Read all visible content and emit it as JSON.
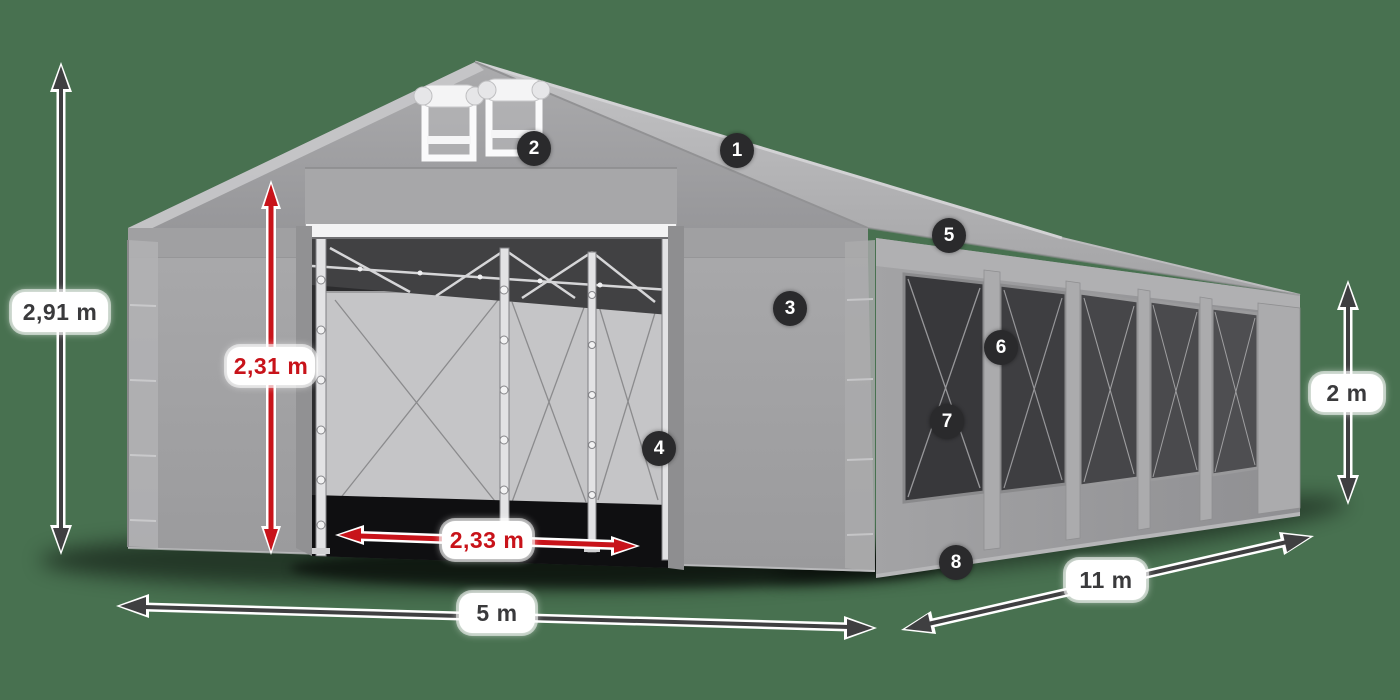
{
  "scene": {
    "name": "party-tent-dimensions-diagram",
    "colors": {
      "background": "#487150",
      "red_accent": "#c8131a",
      "dark_arrow": "#3f3f41",
      "badge_bg": "#2a2a2c",
      "tent_gray": "#a2a2a4",
      "pill_bg": "#ffffff"
    }
  },
  "dimensions": [
    {
      "id": "total-height",
      "label": "2,91 m",
      "style": "dark"
    },
    {
      "id": "entrance-height",
      "label": "2,31 m",
      "style": "red"
    },
    {
      "id": "entrance-width",
      "label": "2,33 m",
      "style": "red"
    },
    {
      "id": "front-width",
      "label": "5 m",
      "style": "dark"
    },
    {
      "id": "side-length",
      "label": "11 m",
      "style": "dark"
    },
    {
      "id": "side-height",
      "label": "2 m",
      "style": "dark"
    }
  ],
  "badges": [
    {
      "label": "1"
    },
    {
      "label": "2"
    },
    {
      "label": "3"
    },
    {
      "label": "4"
    },
    {
      "label": "5"
    },
    {
      "label": "6"
    },
    {
      "label": "7"
    },
    {
      "label": "8"
    }
  ]
}
